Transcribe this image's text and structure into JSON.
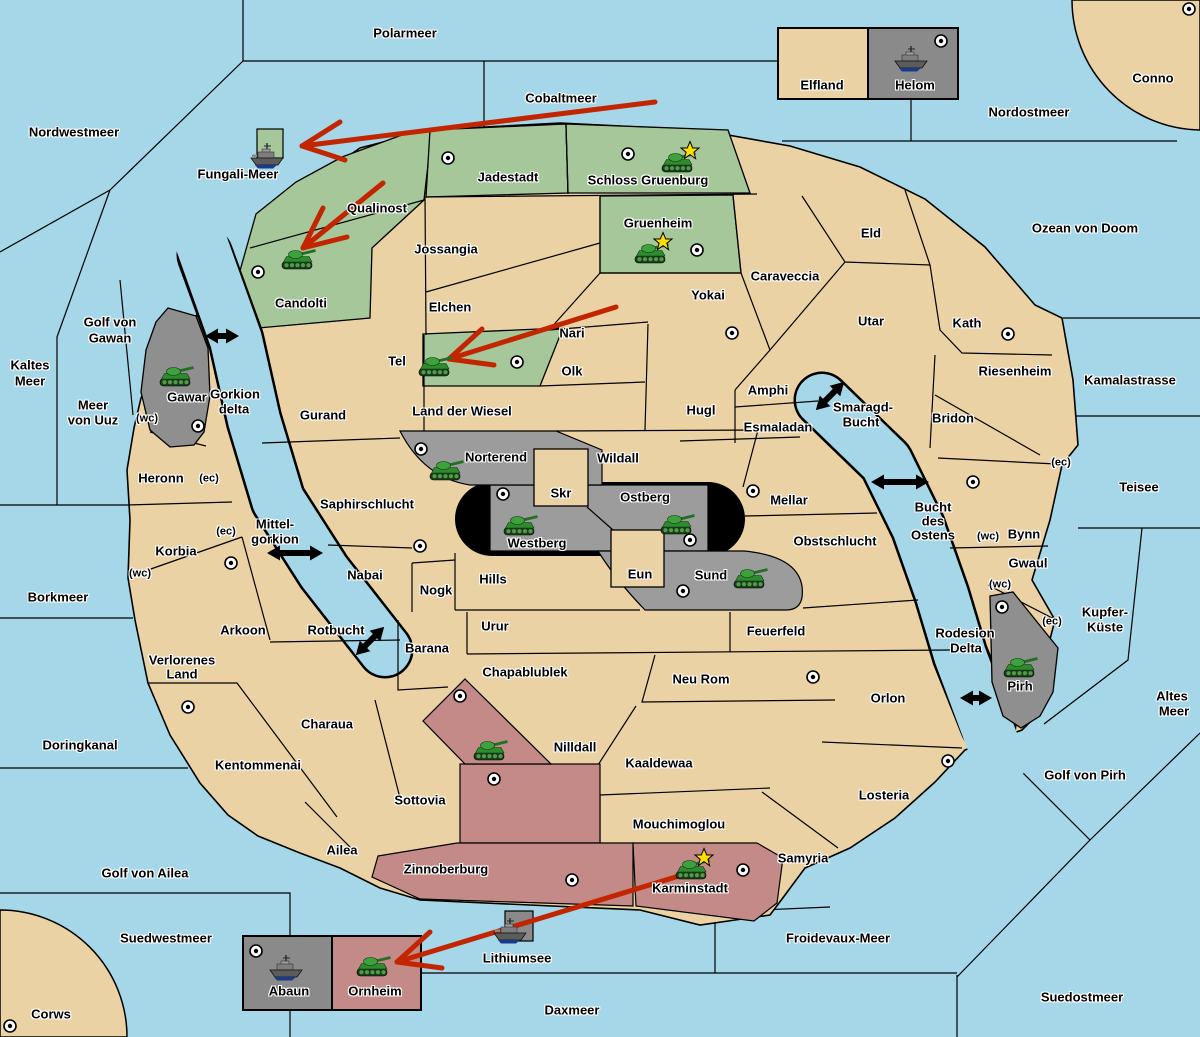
{
  "map": {
    "colors": {
      "ocean": "#a5d7e8",
      "land": "#ebd2a4",
      "green": "#a6c79a",
      "gray": "#9c9c9c",
      "gray_delta": "#8f8f8f",
      "gray_box": "#8a8a8a",
      "pink": "#c38a88",
      "black_zone": "#000000",
      "arrow_red": "#c22500",
      "star": "#ffdf00",
      "border": "#000000"
    },
    "sea_labels": [
      {
        "text": "Polarmeer",
        "x": 405,
        "y": 33
      },
      {
        "text": "Nordwestmeer",
        "x": 74,
        "y": 132
      },
      {
        "text": "Cobaltmeer",
        "x": 561,
        "y": 98
      },
      {
        "text": "Fungali-Meer",
        "x": 238,
        "y": 174
      },
      {
        "text": "Nordostmeer",
        "x": 1029,
        "y": 112
      },
      {
        "text": "Ozean von Doom",
        "x": 1085,
        "y": 228
      },
      {
        "text": "Kaltes",
        "x": 30,
        "y": 365
      },
      {
        "text": "Meer",
        "x": 30,
        "y": 381
      },
      {
        "text": "Golf von",
        "x": 110,
        "y": 322
      },
      {
        "text": "Gawan",
        "x": 110,
        "y": 338
      },
      {
        "text": "Meer",
        "x": 93,
        "y": 405
      },
      {
        "text": "von Uuz",
        "x": 93,
        "y": 420
      },
      {
        "text": "Kamalastrasse",
        "x": 1130,
        "y": 380
      },
      {
        "text": "Teisee",
        "x": 1139,
        "y": 487
      },
      {
        "text": "Borkmeer",
        "x": 58,
        "y": 597
      },
      {
        "text": "Doringkanal",
        "x": 80,
        "y": 745
      },
      {
        "text": "Kupfer-",
        "x": 1105,
        "y": 612
      },
      {
        "text": "Küste",
        "x": 1105,
        "y": 627
      },
      {
        "text": "Altes",
        "x": 1172,
        "y": 696
      },
      {
        "text": "Meer",
        "x": 1174,
        "y": 711
      },
      {
        "text": "Golf von Pirh",
        "x": 1085,
        "y": 775
      },
      {
        "text": "Golf von Ailea",
        "x": 145,
        "y": 873
      },
      {
        "text": "Suedwestmeer",
        "x": 166,
        "y": 938
      },
      {
        "text": "Froidevaux-Meer",
        "x": 838,
        "y": 938
      },
      {
        "text": "Daxmeer",
        "x": 572,
        "y": 1010
      },
      {
        "text": "Suedostmeer",
        "x": 1082,
        "y": 997
      },
      {
        "text": "Lithiumsee",
        "x": 517,
        "y": 958
      },
      {
        "text": "Smaragd-",
        "x": 863,
        "y": 407
      },
      {
        "text": "Bucht",
        "x": 861,
        "y": 422
      },
      {
        "text": "Bucht",
        "x": 933,
        "y": 507
      },
      {
        "text": "des",
        "x": 933,
        "y": 521
      },
      {
        "text": "Ostens",
        "x": 933,
        "y": 535
      },
      {
        "text": "Rodesion",
        "x": 965,
        "y": 633
      },
      {
        "text": "Delta",
        "x": 966,
        "y": 648
      },
      {
        "text": "Gorkion",
        "x": 235,
        "y": 394
      },
      {
        "text": "delta",
        "x": 234,
        "y": 409
      },
      {
        "text": "Mittel-",
        "x": 275,
        "y": 524
      },
      {
        "text": "gorkion",
        "x": 275,
        "y": 539
      },
      {
        "text": "Rotbucht",
        "x": 336,
        "y": 630
      }
    ],
    "territory_labels": [
      {
        "text": "Jadestadt",
        "x": 508,
        "y": 177
      },
      {
        "text": "Schloss Gruenburg",
        "x": 648,
        "y": 180
      },
      {
        "text": "Qualinost",
        "x": 377,
        "y": 208
      },
      {
        "text": "Candolti",
        "x": 301,
        "y": 303
      },
      {
        "text": "Gruenheim",
        "x": 658,
        "y": 223
      },
      {
        "text": "Jossangia",
        "x": 446,
        "y": 249
      },
      {
        "text": "Elchen",
        "x": 450,
        "y": 307
      },
      {
        "text": "Nari",
        "x": 572,
        "y": 333
      },
      {
        "text": "Tel",
        "x": 397,
        "y": 361
      },
      {
        "text": "Olk",
        "x": 572,
        "y": 371
      },
      {
        "text": "Gurand",
        "x": 323,
        "y": 415
      },
      {
        "text": "Land der Wiesel",
        "x": 462,
        "y": 411
      },
      {
        "text": "Hugl",
        "x": 701,
        "y": 410
      },
      {
        "text": "Amphi",
        "x": 768,
        "y": 390
      },
      {
        "text": "Esmaladan",
        "x": 778,
        "y": 427
      },
      {
        "text": "Caraveccia",
        "x": 785,
        "y": 276
      },
      {
        "text": "Yokai",
        "x": 708,
        "y": 295
      },
      {
        "text": "Eld",
        "x": 871,
        "y": 233
      },
      {
        "text": "Utar",
        "x": 871,
        "y": 321
      },
      {
        "text": "Kath",
        "x": 967,
        "y": 323
      },
      {
        "text": "Riesenheim",
        "x": 1015,
        "y": 371
      },
      {
        "text": "Bridon",
        "x": 953,
        "y": 418
      },
      {
        "text": "Wildall",
        "x": 618,
        "y": 458
      },
      {
        "text": "Skr",
        "x": 561,
        "y": 493
      },
      {
        "text": "Ostberg",
        "x": 645,
        "y": 497
      },
      {
        "text": "Westberg",
        "x": 537,
        "y": 543
      },
      {
        "text": "Norterend",
        "x": 496,
        "y": 457
      },
      {
        "text": "Mellar",
        "x": 789,
        "y": 500
      },
      {
        "text": "Obstschlucht",
        "x": 835,
        "y": 541
      },
      {
        "text": "Sund",
        "x": 711,
        "y": 575
      },
      {
        "text": "Eun",
        "x": 640,
        "y": 574
      },
      {
        "text": "Hills",
        "x": 493,
        "y": 579
      },
      {
        "text": "Nogk",
        "x": 436,
        "y": 590
      },
      {
        "text": "Saphirschlucht",
        "x": 367,
        "y": 504
      },
      {
        "text": "Nabai",
        "x": 365,
        "y": 575
      },
      {
        "text": "Urur",
        "x": 495,
        "y": 626
      },
      {
        "text": "Feuerfeld",
        "x": 776,
        "y": 631
      },
      {
        "text": "Barana",
        "x": 427,
        "y": 648
      },
      {
        "text": "Chapablublek",
        "x": 525,
        "y": 672
      },
      {
        "text": "Neu Rom",
        "x": 701,
        "y": 679
      },
      {
        "text": "Nilldall",
        "x": 575,
        "y": 747
      },
      {
        "text": "Kaaldewaa",
        "x": 659,
        "y": 763
      },
      {
        "text": "Arkoon",
        "x": 243,
        "y": 630
      },
      {
        "text": "Verlorenes",
        "x": 182,
        "y": 660
      },
      {
        "text": "Land",
        "x": 182,
        "y": 674
      },
      {
        "text": "Charaua",
        "x": 327,
        "y": 724
      },
      {
        "text": "Kentommenai",
        "x": 258,
        "y": 765
      },
      {
        "text": "Sottovia",
        "x": 420,
        "y": 800
      },
      {
        "text": "Ailea",
        "x": 342,
        "y": 850
      },
      {
        "text": "Heronn",
        "x": 161,
        "y": 478
      },
      {
        "text": "Korbia",
        "x": 176,
        "y": 551
      },
      {
        "text": "Mouchimoglou",
        "x": 679,
        "y": 824
      },
      {
        "text": "Zinnoberburg",
        "x": 446,
        "y": 869
      },
      {
        "text": "Karminstadt",
        "x": 690,
        "y": 888
      },
      {
        "text": "Samyria",
        "x": 803,
        "y": 858
      },
      {
        "text": "Orlon",
        "x": 888,
        "y": 698
      },
      {
        "text": "Losteria",
        "x": 884,
        "y": 795
      },
      {
        "text": "Bynn",
        "x": 1024,
        "y": 534
      },
      {
        "text": "Gwaul",
        "x": 1028,
        "y": 563
      },
      {
        "text": "Gawar",
        "x": 187,
        "y": 397
      },
      {
        "text": "Pirh",
        "x": 1020,
        "y": 686
      },
      {
        "text": "Elfland",
        "x": 822,
        "y": 85
      },
      {
        "text": "Helom",
        "x": 915,
        "y": 85
      },
      {
        "text": "Abaun",
        "x": 289,
        "y": 991
      },
      {
        "text": "Ornheim",
        "x": 375,
        "y": 991
      },
      {
        "text": "Conno",
        "x": 1153,
        "y": 78
      },
      {
        "text": "Corws",
        "x": 51,
        "y": 1014
      }
    ],
    "small_labels": [
      {
        "text": "(wc)",
        "x": 147,
        "y": 419
      },
      {
        "text": "(ec)",
        "x": 209,
        "y": 479
      },
      {
        "text": "(ec)",
        "x": 226,
        "y": 532
      },
      {
        "text": "(wc)",
        "x": 140,
        "y": 574
      },
      {
        "text": "(ec)",
        "x": 1061,
        "y": 463
      },
      {
        "text": "(wc)",
        "x": 988,
        "y": 537
      },
      {
        "text": "(wc)",
        "x": 1000,
        "y": 585
      },
      {
        "text": "(ec)",
        "x": 1052,
        "y": 622
      }
    ],
    "cities": [
      [
        448,
        158
      ],
      [
        628,
        154
      ],
      [
        697,
        250
      ],
      [
        258,
        272
      ],
      [
        1189,
        9
      ],
      [
        941,
        41
      ],
      [
        732,
        333
      ],
      [
        1008,
        334
      ],
      [
        517,
        362
      ],
      [
        198,
        426
      ],
      [
        421,
        449
      ],
      [
        503,
        494
      ],
      [
        690,
        540
      ],
      [
        683,
        591
      ],
      [
        753,
        491
      ],
      [
        973,
        482
      ],
      [
        1002,
        607
      ],
      [
        231,
        563
      ],
      [
        420,
        546
      ],
      [
        188,
        707
      ],
      [
        460,
        696
      ],
      [
        494,
        779
      ],
      [
        813,
        677
      ],
      [
        948,
        761
      ],
      [
        572,
        880
      ],
      [
        743,
        870
      ],
      [
        10,
        1026
      ],
      [
        256,
        951
      ]
    ],
    "units": {
      "tanks": [
        {
          "territory": "Schloss Gruenburg",
          "x": 677,
          "y": 162,
          "star": true
        },
        {
          "territory": "Gruenheim",
          "x": 650,
          "y": 253,
          "star": true
        },
        {
          "territory": "Candolti",
          "x": 297,
          "y": 259,
          "star": false
        },
        {
          "territory": "Tel",
          "x": 434,
          "y": 366,
          "star": false
        },
        {
          "territory": "Gawar",
          "x": 175,
          "y": 376,
          "star": false
        },
        {
          "territory": "Norterend",
          "x": 445,
          "y": 470,
          "star": false
        },
        {
          "territory": "Westberg",
          "x": 519,
          "y": 525,
          "star": false
        },
        {
          "territory": "Ostberg",
          "x": 676,
          "y": 524,
          "star": false
        },
        {
          "territory": "Sund",
          "x": 749,
          "y": 578,
          "star": false
        },
        {
          "territory": "Pirh",
          "x": 1019,
          "y": 667,
          "star": false
        },
        {
          "territory": "Qwil",
          "x": 489,
          "y": 750,
          "star": false
        },
        {
          "territory": "Karminstadt",
          "x": 691,
          "y": 869,
          "star": true
        },
        {
          "territory": "Ornheim",
          "x": 372,
          "y": 966,
          "star": false
        }
      ],
      "ships": [
        {
          "territory": "Fungali-Meer",
          "x": 268,
          "y": 157
        },
        {
          "territory": "Helom",
          "x": 912,
          "y": 60
        },
        {
          "territory": "Lithiumsee",
          "x": 511,
          "y": 932
        },
        {
          "territory": "Abaun",
          "x": 287,
          "y": 969
        }
      ]
    },
    "red_arrows": [
      {
        "x1": 655,
        "y1": 102,
        "x2": 302,
        "y2": 146,
        "barbs": [
          [
            340,
            122
          ],
          [
            345,
            160
          ]
        ]
      },
      {
        "x1": 383,
        "y1": 183,
        "x2": 303,
        "y2": 248,
        "barbs": [
          [
            347,
            237
          ],
          [
            323,
            208
          ]
        ]
      },
      {
        "x1": 616,
        "y1": 307,
        "x2": 449,
        "y2": 359,
        "barbs": [
          [
            494,
            365
          ],
          [
            482,
            329
          ]
        ]
      },
      {
        "x1": 692,
        "y1": 872,
        "x2": 397,
        "y2": 962,
        "barbs": [
          [
            442,
            968
          ],
          [
            430,
            932
          ]
        ]
      }
    ],
    "double_arrows": [
      {
        "x": 222,
        "y": 336,
        "len": 17,
        "angle": 0
      },
      {
        "x": 295,
        "y": 553,
        "len": 28,
        "angle": 0
      },
      {
        "x": 370,
        "y": 641,
        "len": 20,
        "angle": -45
      },
      {
        "x": 830,
        "y": 396,
        "len": 20,
        "angle": -45
      },
      {
        "x": 900,
        "y": 482,
        "len": 29,
        "angle": 0
      },
      {
        "x": 976,
        "y": 698,
        "len": 16,
        "angle": 0
      }
    ]
  }
}
